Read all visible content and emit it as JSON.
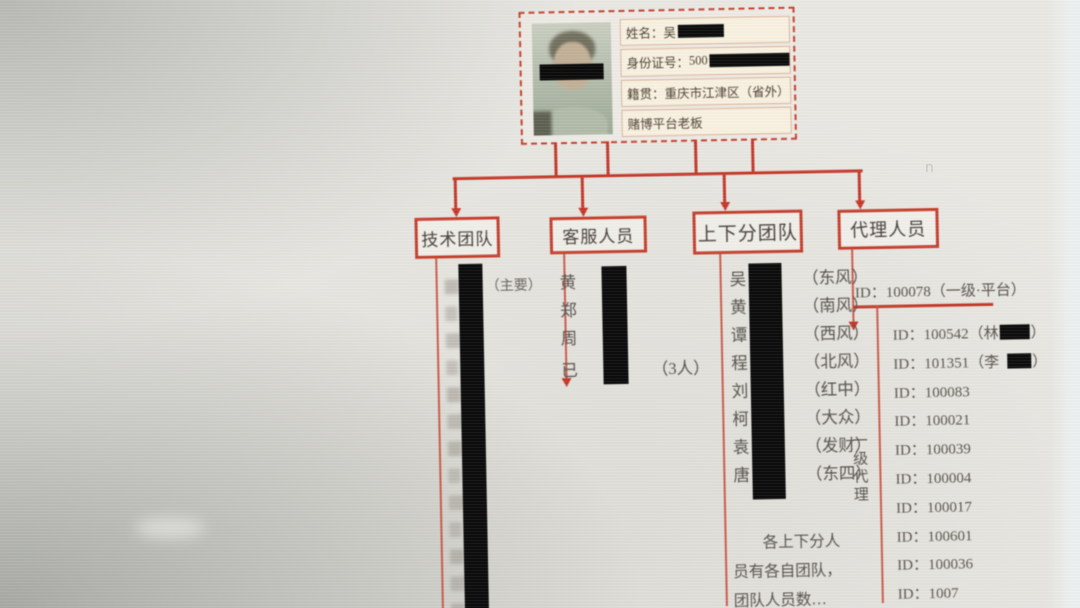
{
  "meta": {
    "accent_red": "#c5392b",
    "redaction_black": "#0d0d0d",
    "stray_mark": "n"
  },
  "profile_card": {
    "photo": "portrait-with-eye-redaction",
    "fields": [
      {
        "label": "姓名：",
        "value": "吴",
        "redacted_after": true
      },
      {
        "label": "身份证号：",
        "value": "500",
        "redacted_after": true
      },
      {
        "label": "籍贯：",
        "value": "重庆市江津区（省外）",
        "redacted_after": false
      },
      {
        "label": "",
        "value": "赌博平台老板",
        "redacted_after": false
      }
    ]
  },
  "branches": {
    "tech": {
      "title": "技术团队",
      "first_note": "（主要）",
      "redacted_rows": 13
    },
    "service": {
      "title": "客服人员",
      "members": [
        "黄",
        "郑",
        "周"
      ],
      "footer_prefix": "已",
      "footer_suffix": "（3人）"
    },
    "updown": {
      "title": "上下分团队",
      "members": [
        {
          "surname": "吴",
          "tag": "（东风）"
        },
        {
          "surname": "黄",
          "tag": "（南风）"
        },
        {
          "surname": "谭",
          "tag": "（西风）"
        },
        {
          "surname": "程",
          "tag": "（北风）"
        },
        {
          "surname": "刘",
          "tag": "（红中）"
        },
        {
          "surname": "柯",
          "tag": "（大众）"
        },
        {
          "surname": "袁",
          "tag": "（发财）"
        },
        {
          "surname": "唐",
          "tag": "（东四）"
        }
      ],
      "note_lines": [
        "各上下分人",
        "员有各自团队，",
        "团队人员数…"
      ]
    },
    "agent": {
      "title": "代理人员",
      "top_entry": "ID：100078（一级·平台）",
      "side_label": "一级代理",
      "ids": [
        {
          "id": "ID：100542",
          "name_prefix": "（林",
          "suffix": "）"
        },
        {
          "id": "ID：101351",
          "name_prefix": "（李",
          "suffix": "）"
        },
        {
          "id": "ID：100083"
        },
        {
          "id": "ID：100021"
        },
        {
          "id": "ID：100039"
        },
        {
          "id": "ID：100004"
        },
        {
          "id": "ID：100017"
        },
        {
          "id": "ID：100601"
        },
        {
          "id": "ID：100036"
        },
        {
          "id": "ID：1007"
        }
      ]
    }
  }
}
